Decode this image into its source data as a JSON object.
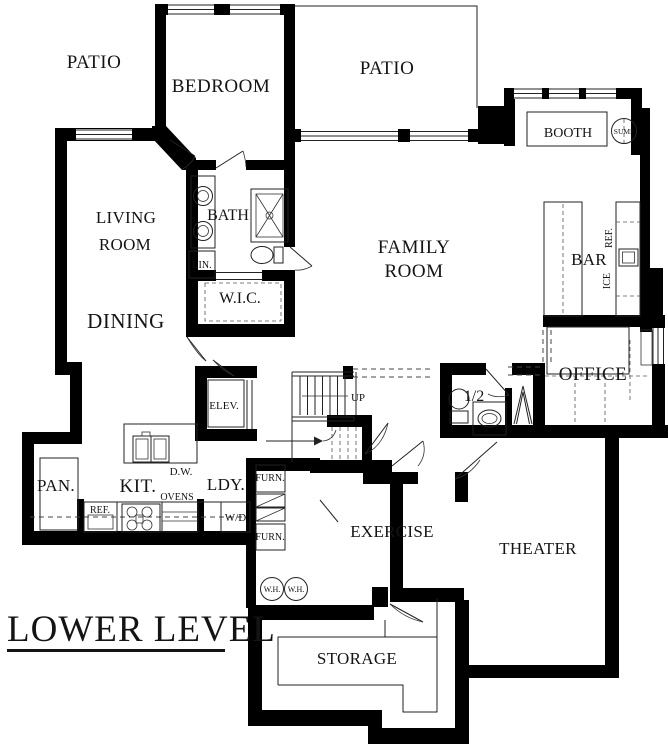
{
  "colors": {
    "wall": "#000000",
    "background": "#ffffff",
    "ink": "#141414"
  },
  "plan": {
    "type": "architectural floor plan",
    "level_title": "LOWER LEVEL"
  },
  "labels": {
    "title": "LOWER LEVEL",
    "patio_left": "PATIO",
    "bedroom": "BEDROOM",
    "patio_right": "PATIO",
    "booth": "BOOTH",
    "sump": "SUMP",
    "living_1": "LIVING",
    "living_2": "ROOM",
    "bath": "BATH",
    "lin": "LIN.",
    "wic": "W.I.C.",
    "family_1": "FAMILY",
    "family_2": "ROOM",
    "bar": "BAR",
    "bar_ref": "REF.",
    "bar_ice": "ICE",
    "office": "OFFICE",
    "dining": "DINING",
    "elev": "ELEV.",
    "up": "UP",
    "half_bath": "1/2",
    "pan": "PAN.",
    "kit": "KIT.",
    "kitchen_ref": "REF.",
    "ovens": "OVENS",
    "dw": "D.W.",
    "ldy": "LDY.",
    "wd": "W/D",
    "furn_1": "FURN.",
    "furn_2": "FURN.",
    "wh_1": "W.H.",
    "wh_2": "W.H.",
    "exercise": "EXERCISE",
    "theater": "THEATER",
    "storage": "STORAGE"
  }
}
